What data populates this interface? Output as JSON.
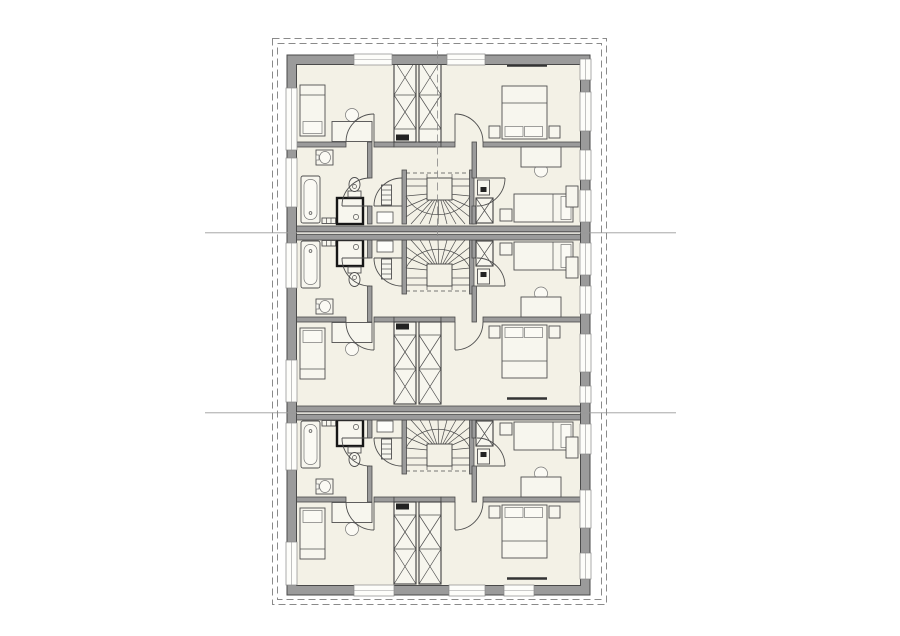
{
  "meta": {
    "title": "multi-unit-floor-plan",
    "units_count": 3
  },
  "colors": {
    "background": "#ffffff",
    "floor": "#f3f1e6",
    "wall_fill": "#9b9b9b",
    "wall_stroke": "#4a4a4a",
    "line": "#4f4f4f",
    "furniture_fill": "#f7f6ee",
    "furniture_light": "#fbfaf4",
    "white_fixture": "#fdfdfa",
    "shower_stroke": "#161616",
    "boundary_dash": "#8a8a8a",
    "reference_line": "#9a9a9a",
    "dark_fill": "#222222"
  },
  "canvas": {
    "width": 900,
    "height": 636
  },
  "units": [
    {
      "name": "unit-top",
      "transform": "translate(0,464) scale(1,-1)"
    },
    {
      "name": "unit-middle",
      "transform": ""
    },
    {
      "name": "unit-bottom",
      "transform": "translate(0,180)"
    }
  ],
  "globals_under": [
    {
      "t": "r",
      "x": 287,
      "y": 55,
      "w": 303,
      "h": 540,
      "c": "floor",
      "n": "building-floor"
    }
  ],
  "unit_template": [
    {
      "t": "r",
      "x": 402,
      "y": 240,
      "w": 4.5,
      "h": 54,
      "c": "wall",
      "n": "stair-wall"
    },
    {
      "t": "r",
      "x": 469.5,
      "y": 240,
      "w": 4.5,
      "h": 54,
      "c": "wall",
      "n": "stair-wall"
    },
    {
      "t": "r",
      "x": 367.5,
      "y": 240,
      "w": 4.5,
      "h": 18,
      "c": "wall",
      "n": "bathroom-wall"
    },
    {
      "t": "r",
      "x": 367.5,
      "y": 286,
      "w": 4.5,
      "h": 36,
      "c": "wall",
      "n": "bathroom-wall"
    },
    {
      "t": "r",
      "x": 472,
      "y": 240,
      "w": 4.5,
      "h": 18,
      "c": "wall",
      "n": "bedroom-wall"
    },
    {
      "t": "r",
      "x": 472,
      "y": 286,
      "w": 4.5,
      "h": 36,
      "c": "wall",
      "n": "bedroom-wall"
    },
    {
      "t": "r",
      "x": 296,
      "y": 317,
      "w": 50,
      "h": 5,
      "c": "wall",
      "n": "corridor-wall"
    },
    {
      "t": "r",
      "x": 374,
      "y": 317,
      "w": 20,
      "h": 5,
      "c": "wall",
      "n": "corridor-wall"
    },
    {
      "t": "r",
      "x": 394,
      "y": 317,
      "w": 47,
      "h": 5,
      "c": "wall",
      "n": "shaft-wall"
    },
    {
      "t": "r",
      "x": 441,
      "y": 317,
      "w": 14,
      "h": 5,
      "c": "wall",
      "n": "corridor-wall"
    },
    {
      "t": "r",
      "x": 483,
      "y": 317,
      "w": 98,
      "h": 5,
      "c": "wall",
      "n": "corridor-wall"
    },
    {
      "t": "l",
      "x1": 439,
      "y1": 271,
      "x2": 406,
      "y2": 268,
      "c": "ln",
      "n": "stair-tread"
    },
    {
      "t": "l",
      "x1": 439,
      "y1": 271,
      "x2": 406,
      "y2": 257,
      "c": "ln",
      "n": "stair-tread"
    },
    {
      "t": "l",
      "x1": 439,
      "y1": 271,
      "x2": 406,
      "y2": 247,
      "c": "ln",
      "n": "stair-tread"
    },
    {
      "t": "l",
      "x1": 439,
      "y1": 271,
      "x2": 411,
      "y2": 240,
      "c": "ln",
      "n": "stair-tread"
    },
    {
      "t": "l",
      "x1": 439,
      "y1": 271,
      "x2": 420,
      "y2": 240,
      "c": "ln",
      "n": "stair-tread"
    },
    {
      "t": "l",
      "x1": 439,
      "y1": 271,
      "x2": 429,
      "y2": 240,
      "c": "ln",
      "n": "stair-tread"
    },
    {
      "t": "l",
      "x1": 439,
      "y1": 271,
      "x2": 438,
      "y2": 240,
      "c": "ln",
      "n": "stair-tread"
    },
    {
      "t": "l",
      "x1": 439,
      "y1": 271,
      "x2": 447,
      "y2": 240,
      "c": "ln",
      "n": "stair-tread"
    },
    {
      "t": "l",
      "x1": 439,
      "y1": 271,
      "x2": 456,
      "y2": 240,
      "c": "ln",
      "n": "stair-tread"
    },
    {
      "t": "l",
      "x1": 439,
      "y1": 271,
      "x2": 465,
      "y2": 240,
      "c": "ln",
      "n": "stair-tread"
    },
    {
      "t": "l",
      "x1": 439,
      "y1": 271,
      "x2": 470,
      "y2": 247,
      "c": "ln",
      "n": "stair-tread"
    },
    {
      "t": "l",
      "x1": 439,
      "y1": 271,
      "x2": 470,
      "y2": 257,
      "c": "ln",
      "n": "stair-tread"
    },
    {
      "t": "l",
      "x1": 439,
      "y1": 271,
      "x2": 470,
      "y2": 268,
      "c": "ln",
      "n": "stair-tread"
    },
    {
      "t": "p",
      "d": "M406,268 C418,243 458,243 470,268",
      "c": "ln",
      "n": "stair-walk-line"
    },
    {
      "t": "r",
      "x": 427,
      "y": 264,
      "w": 25,
      "h": 22,
      "c": "core",
      "n": "stair-core"
    },
    {
      "t": "l",
      "x1": 406,
      "y1": 278,
      "x2": 427,
      "y2": 278,
      "c": "ln",
      "n": "stair-tread"
    },
    {
      "t": "l",
      "x1": 406,
      "y1": 285,
      "x2": 427,
      "y2": 285,
      "c": "ln",
      "n": "stair-tread"
    },
    {
      "t": "l",
      "x1": 452,
      "y1": 278,
      "x2": 470,
      "y2": 278,
      "c": "ln",
      "n": "stair-tread"
    },
    {
      "t": "l",
      "x1": 452,
      "y1": 285,
      "x2": 470,
      "y2": 285,
      "c": "ln",
      "n": "stair-tread"
    },
    {
      "t": "l",
      "x1": 427,
      "y1": 271,
      "x2": 427,
      "y2": 290,
      "c": "ln",
      "n": "stair-stringer"
    },
    {
      "t": "l",
      "x1": 452,
      "y1": 271,
      "x2": 452,
      "y2": 290,
      "c": "ln",
      "n": "stair-stringer"
    },
    {
      "t": "l",
      "x1": 406,
      "y1": 291,
      "x2": 470,
      "y2": 291,
      "c": "dash",
      "n": "stair-cut-line"
    },
    {
      "t": "r",
      "x": 476,
      "y": 241,
      "w": 17,
      "h": 25,
      "c": "shaft",
      "n": "duct"
    },
    {
      "t": "l",
      "x1": 476,
      "y1": 241,
      "x2": 493,
      "y2": 266,
      "c": "ln",
      "n": "duct-brace"
    },
    {
      "t": "l",
      "x1": 493,
      "y1": 241,
      "x2": 476,
      "y2": 266,
      "c": "ln",
      "n": "duct-brace"
    },
    {
      "t": "r",
      "x": 477.5,
      "y": 269,
      "w": 12,
      "h": 15,
      "c": "furn",
      "n": "duct-box"
    },
    {
      "t": "r",
      "x": 480.5,
      "y": 272,
      "w": 6,
      "h": 5,
      "c": "dark",
      "n": "duct-vent"
    },
    {
      "t": "r",
      "x": 394,
      "y": 322,
      "w": 22,
      "h": 82,
      "c": "shaft",
      "n": "installation-shaft"
    },
    {
      "t": "l",
      "x1": 394,
      "y1": 335,
      "x2": 416,
      "y2": 335,
      "c": "ln",
      "n": "shaft-divider"
    },
    {
      "t": "l",
      "x1": 394,
      "y1": 369,
      "x2": 416,
      "y2": 369,
      "c": "ln",
      "n": "shaft-divider"
    },
    {
      "t": "l",
      "x1": 394,
      "y1": 335,
      "x2": 416,
      "y2": 369,
      "c": "ln",
      "n": "shaft-brace"
    },
    {
      "t": "l",
      "x1": 416,
      "y1": 335,
      "x2": 394,
      "y2": 369,
      "c": "ln",
      "n": "shaft-brace"
    },
    {
      "t": "l",
      "x1": 394,
      "y1": 369,
      "x2": 416,
      "y2": 404,
      "c": "ln",
      "n": "shaft-brace"
    },
    {
      "t": "l",
      "x1": 416,
      "y1": 369,
      "x2": 394,
      "y2": 404,
      "c": "ln",
      "n": "shaft-brace"
    },
    {
      "t": "r",
      "x": 396,
      "y": 323.5,
      "w": 13,
      "h": 6,
      "c": "dark",
      "n": "shaft-vent"
    },
    {
      "t": "r",
      "x": 419,
      "y": 322,
      "w": 22,
      "h": 82,
      "c": "shaft",
      "n": "installation-shaft"
    },
    {
      "t": "l",
      "x1": 419,
      "y1": 335,
      "x2": 441,
      "y2": 335,
      "c": "ln",
      "n": "shaft-divider"
    },
    {
      "t": "l",
      "x1": 419,
      "y1": 369,
      "x2": 441,
      "y2": 369,
      "c": "ln",
      "n": "shaft-divider"
    },
    {
      "t": "l",
      "x1": 419,
      "y1": 335,
      "x2": 441,
      "y2": 369,
      "c": "ln",
      "n": "shaft-brace"
    },
    {
      "t": "l",
      "x1": 441,
      "y1": 335,
      "x2": 419,
      "y2": 369,
      "c": "ln",
      "n": "shaft-brace"
    },
    {
      "t": "l",
      "x1": 419,
      "y1": 369,
      "x2": 441,
      "y2": 404,
      "c": "ln",
      "n": "shaft-brace"
    },
    {
      "t": "l",
      "x1": 441,
      "y1": 369,
      "x2": 419,
      "y2": 404,
      "c": "ln",
      "n": "shaft-brace"
    },
    {
      "t": "r",
      "x": 301,
      "y": 241,
      "w": 19,
      "h": 47,
      "rx": 2,
      "c": "furn",
      "n": "bathtub"
    },
    {
      "t": "r",
      "x": 304,
      "y": 244.5,
      "w": 13,
      "h": 40,
      "rx": 6,
      "c": "furn2",
      "n": "bathtub-inner"
    },
    {
      "t": "c",
      "cx": 310.5,
      "cy": 251,
      "r": 1.4,
      "c": "ln",
      "n": "bathtub-drain"
    },
    {
      "t": "r",
      "x": 322,
      "y": 240.5,
      "w": 17,
      "h": 5.5,
      "c": "furn",
      "n": "radiator"
    },
    {
      "t": "l",
      "x1": 326.5,
      "y1": 240.5,
      "x2": 326.5,
      "y2": 246,
      "c": "ln",
      "n": "radiator-fin"
    },
    {
      "t": "l",
      "x1": 331,
      "y1": 240.5,
      "x2": 331,
      "y2": 246,
      "c": "ln",
      "n": "radiator-fin"
    },
    {
      "t": "l",
      "x1": 335.5,
      "y1": 240.5,
      "x2": 335.5,
      "y2": 246,
      "c": "ln",
      "n": "radiator-fin"
    },
    {
      "t": "r",
      "x": 337,
      "y": 240,
      "w": 26,
      "h": 26,
      "c": "shower",
      "n": "shower"
    },
    {
      "t": "c",
      "cx": 356,
      "cy": 247,
      "r": 2.6,
      "c": "ln",
      "n": "shower-drain"
    },
    {
      "t": "r",
      "x": 348,
      "y": 267,
      "w": 13,
      "h": 6,
      "c": "furn",
      "n": "toilet-tank"
    },
    {
      "t": "e",
      "cx": 354.5,
      "cy": 279.5,
      "rx": 5.5,
      "ry": 7,
      "c": "furn",
      "n": "toilet-bowl"
    },
    {
      "t": "c",
      "cx": 354.5,
      "cy": 277.5,
      "r": 2,
      "c": "ln",
      "n": "toilet-detail"
    },
    {
      "t": "r",
      "x": 316,
      "y": 299,
      "w": 17,
      "h": 15,
      "c": "furn",
      "n": "sink"
    },
    {
      "t": "e",
      "cx": 325,
      "cy": 306.5,
      "rx": 5.5,
      "ry": 6,
      "c": "furn2",
      "n": "sink-basin"
    },
    {
      "t": "r",
      "x": 316,
      "y": 304,
      "w": 3,
      "h": 5,
      "c": "furn2",
      "n": "sink-tap"
    },
    {
      "t": "r",
      "x": 377,
      "y": 241,
      "w": 16,
      "h": 11,
      "c": "white",
      "n": "shelf"
    },
    {
      "t": "r",
      "x": 381.5,
      "y": 259,
      "w": 10,
      "h": 20,
      "c": "furn",
      "n": "radiator"
    },
    {
      "t": "l",
      "x1": 381.5,
      "y1": 264,
      "x2": 391.5,
      "y2": 264,
      "c": "ln",
      "n": "radiator-fin"
    },
    {
      "t": "l",
      "x1": 381.5,
      "y1": 269,
      "x2": 391.5,
      "y2": 269,
      "c": "ln",
      "n": "radiator-fin"
    },
    {
      "t": "l",
      "x1": 381.5,
      "y1": 274,
      "x2": 391.5,
      "y2": 274,
      "c": "ln",
      "n": "radiator-fin"
    },
    {
      "t": "c",
      "cx": 541,
      "cy": 293.5,
      "r": 6.5,
      "c": "furn2",
      "n": "chair"
    },
    {
      "t": "r",
      "x": 521,
      "y": 297,
      "w": 40,
      "h": 20,
      "c": "furn",
      "n": "desk"
    },
    {
      "t": "r",
      "x": 514,
      "y": 242,
      "w": 59,
      "h": 28,
      "c": "furn",
      "n": "single-bed"
    },
    {
      "t": "r",
      "x": 561,
      "y": 244.5,
      "w": 10,
      "h": 23,
      "c": "furn2",
      "n": "pillow"
    },
    {
      "t": "l",
      "x1": 553,
      "y1": 242,
      "x2": 553,
      "y2": 270,
      "c": "ln",
      "n": "blanket-line"
    },
    {
      "t": "r",
      "x": 500,
      "y": 243,
      "w": 12,
      "h": 12,
      "c": "furn",
      "n": "nightstand"
    },
    {
      "t": "r",
      "x": 566,
      "y": 257,
      "w": 12,
      "h": 21,
      "c": "furn",
      "n": "wardrobe"
    },
    {
      "t": "r",
      "x": 502,
      "y": 325,
      "w": 45,
      "h": 53,
      "c": "furn",
      "n": "double-bed"
    },
    {
      "t": "r",
      "x": 505,
      "y": 327.5,
      "w": 18,
      "h": 10,
      "c": "furn2",
      "n": "pillow"
    },
    {
      "t": "r",
      "x": 524.5,
      "y": 327.5,
      "w": 18,
      "h": 10,
      "c": "furn2",
      "n": "pillow"
    },
    {
      "t": "l",
      "x1": 502,
      "y1": 361,
      "x2": 547,
      "y2": 361,
      "c": "ln",
      "n": "blanket-line"
    },
    {
      "t": "r",
      "x": 489,
      "y": 326,
      "w": 11,
      "h": 12,
      "c": "furn",
      "n": "nightstand"
    },
    {
      "t": "r",
      "x": 549,
      "y": 326,
      "w": 11,
      "h": 12,
      "c": "furn",
      "n": "nightstand"
    },
    {
      "t": "l",
      "x1": 507,
      "y1": 398.5,
      "x2": 547,
      "y2": 398.5,
      "c": "darkln",
      "n": "wardrobe-front"
    },
    {
      "t": "c",
      "cx": 352,
      "cy": 349,
      "r": 6.5,
      "c": "furn2",
      "n": "chair"
    },
    {
      "t": "r",
      "x": 332,
      "y": 322.5,
      "w": 40,
      "h": 20,
      "c": "furn",
      "n": "desk"
    },
    {
      "t": "r",
      "x": 300,
      "y": 328,
      "w": 25,
      "h": 51,
      "c": "furn",
      "n": "single-bed"
    },
    {
      "t": "r",
      "x": 303,
      "y": 330.5,
      "w": 19,
      "h": 12,
      "c": "furn2",
      "n": "pillow"
    },
    {
      "t": "l",
      "x1": 300,
      "y1": 369,
      "x2": 325,
      "y2": 369,
      "c": "ln",
      "n": "blanket-line"
    },
    {
      "t": "l",
      "x1": 342,
      "y1": 258,
      "x2": 370,
      "y2": 258,
      "c": "door",
      "n": "door-leaf"
    },
    {
      "t": "p",
      "d": "M342,258 A28,28 0 0 0 370,286",
      "c": "door",
      "n": "door-swing"
    },
    {
      "t": "l",
      "x1": 374,
      "y1": 258,
      "x2": 402,
      "y2": 258,
      "c": "door",
      "n": "door-leaf"
    },
    {
      "t": "p",
      "d": "M374,258 A28,28 0 0 0 402,286",
      "c": "door",
      "n": "door-swing"
    },
    {
      "t": "l",
      "x1": 477,
      "y1": 286,
      "x2": 505,
      "y2": 286,
      "c": "door",
      "n": "door-leaf"
    },
    {
      "t": "p",
      "d": "M505,286 A28,28 0 0 0 477,258",
      "c": "door",
      "n": "door-swing"
    },
    {
      "t": "l",
      "x1": 374,
      "y1": 322,
      "x2": 374,
      "y2": 350,
      "c": "door",
      "n": "door-leaf"
    },
    {
      "t": "p",
      "d": "M374,350 A28,28 0 0 1 346,322",
      "c": "door",
      "n": "door-swing"
    },
    {
      "t": "l",
      "x1": 455,
      "y1": 322,
      "x2": 455,
      "y2": 350,
      "c": "door",
      "n": "door-leaf"
    },
    {
      "t": "p",
      "d": "M455,350 A28,28 0 0 0 483,322",
      "c": "door",
      "n": "door-swing"
    }
  ],
  "globals_over": [
    {
      "t": "r",
      "x": 287,
      "y": 226,
      "w": 303,
      "h": 5.5,
      "c": "wall",
      "n": "party-wall"
    },
    {
      "t": "r",
      "x": 287,
      "y": 234.5,
      "w": 303,
      "h": 5.5,
      "c": "wall",
      "n": "party-wall"
    },
    {
      "t": "r",
      "x": 287,
      "y": 406,
      "w": 303,
      "h": 5.5,
      "c": "wall",
      "n": "party-wall"
    },
    {
      "t": "r",
      "x": 287,
      "y": 414.5,
      "w": 303,
      "h": 5.5,
      "c": "wall",
      "n": "party-wall"
    },
    {
      "t": "p",
      "d": "M287,55 H590 V595 H287 Z M296.5,64.5 H580.5 V585.5 H296.5 Z",
      "c": "ring",
      "n": "exterior-wall"
    }
  ],
  "windows": [
    {
      "side": "left",
      "y": 88,
      "len": 62
    },
    {
      "side": "left",
      "y": 158,
      "len": 49
    },
    {
      "side": "left",
      "y": 243,
      "len": 45
    },
    {
      "side": "left",
      "y": 360,
      "len": 42
    },
    {
      "side": "left",
      "y": 423,
      "len": 47
    },
    {
      "side": "left",
      "y": 542,
      "len": 43
    },
    {
      "side": "right",
      "y": 59,
      "len": 21
    },
    {
      "side": "right",
      "y": 92,
      "len": 39
    },
    {
      "side": "right",
      "y": 150,
      "len": 30
    },
    {
      "side": "right",
      "y": 190,
      "len": 32
    },
    {
      "side": "right",
      "y": 243,
      "len": 32
    },
    {
      "side": "right",
      "y": 286,
      "len": 28
    },
    {
      "side": "right",
      "y": 334,
      "len": 38
    },
    {
      "side": "right",
      "y": 386,
      "len": 17
    },
    {
      "side": "right",
      "y": 424,
      "len": 30
    },
    {
      "side": "right",
      "y": 490,
      "len": 38
    },
    {
      "side": "right",
      "y": 553,
      "len": 26
    },
    {
      "side": "top",
      "x": 354,
      "len": 38
    },
    {
      "side": "top",
      "x": 447,
      "len": 38
    },
    {
      "side": "bottom",
      "x": 354,
      "len": 40
    },
    {
      "side": "bottom",
      "x": 449,
      "len": 36
    },
    {
      "side": "bottom",
      "x": 504,
      "len": 30
    }
  ],
  "annotations": [
    {
      "t": "l",
      "x1": 205,
      "y1": 232.8,
      "x2": 676,
      "y2": 232.8,
      "c": "refln",
      "n": "reference-line"
    },
    {
      "t": "l",
      "x1": 205,
      "y1": 412.8,
      "x2": 676,
      "y2": 412.8,
      "c": "refln",
      "n": "reference-line"
    },
    {
      "t": "r",
      "x": 272.5,
      "y": 38.5,
      "w": 334,
      "h": 566,
      "c": "bnd",
      "n": "property-boundary"
    },
    {
      "t": "r",
      "x": 277.5,
      "y": 43.5,
      "w": 324,
      "h": 556,
      "c": "bnd",
      "n": "property-boundary"
    },
    {
      "t": "l",
      "x1": 437.5,
      "y1": 38.5,
      "x2": 437.5,
      "y2": 236,
      "c": "axis",
      "n": "mirror-axis"
    }
  ]
}
